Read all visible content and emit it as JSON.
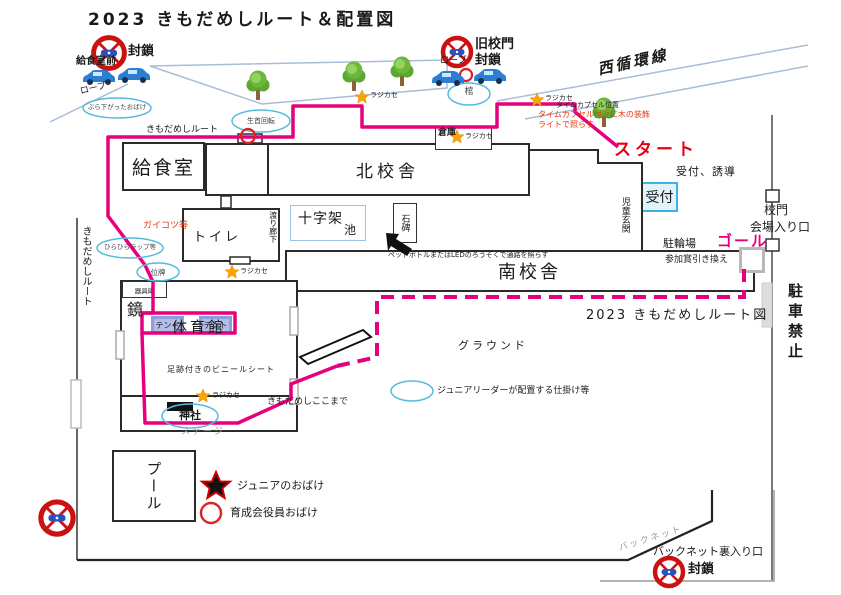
{
  "title": "2023 きもだめしルート＆配置図",
  "colors": {
    "route_pink": "#e6007d",
    "alert_red": "#cc1111",
    "note_red": "#e8380d",
    "star_orange": "#f7a600",
    "oval_blue": "#55bbdd",
    "reception_fill": "#e3f3fb"
  },
  "legend": {
    "junior_ghost": "ジュニアのおばけ",
    "staff_ghost": "育成会役員おばけ"
  },
  "labels": {
    "blockade_top_left": "封鎖",
    "kitchen_front": "給食室前",
    "rope_left": "ロープ",
    "hanging_ghost": "ぶら下がったおばけ",
    "rotating_head": "生首回転",
    "route_top": "きもだめしルート",
    "kitchen": "給食室",
    "north_building": "北校舎",
    "skeletons": "ガイコツ等",
    "flutter_wrap": "ひらひらラップ等",
    "memorial_tablet": "位牌",
    "toilet": "トイレ",
    "corridor": "渡り廊下",
    "cross": "十字架",
    "pond": "池",
    "stone_monument": "石碑",
    "bottle_note": "ペットボトルまたはLEDのろうそくで通路を照らす",
    "warehouse": "倉庫",
    "radio": "ラジカセ",
    "old_gate": "旧校門",
    "blockade_old_gate": "封鎖",
    "rope_right": "ロープ",
    "coffin": "棺",
    "west_loop_line": "西循環線",
    "time_capsule_pos": "タイムカプセル位置",
    "time_capsule_note1": "タイムカプセル付近に木の装飾",
    "time_capsule_note2": "ライトで照らす",
    "start": "スタート",
    "reception_guide": "受付、誘導",
    "reception": "受付",
    "children_entrance": "児童玄関",
    "school_gate": "校門",
    "venue_entrance": "会場入り口",
    "bicycle_parking": "駐輪場",
    "goal": "ゴール",
    "prize_exchange": "参加賞引き換え",
    "no_parking": "駐車禁止",
    "route_map_caption": "2023 きもだめしルート図",
    "south_building": "南校舎",
    "route_left": "きもだめしルート",
    "mirror": "鏡",
    "equipment_room": "器具庫",
    "tent": "テント",
    "gym": "体育館",
    "footprint_sheet": "足跡付きのビニールシート",
    "shrine": "神社",
    "stage": "ステージ",
    "route_end": "きもだめしここまで",
    "ground": "グラウンド",
    "junior_leader_trick": "ジュニアリーダーが配置する仕掛け等",
    "pool": "プール",
    "backnet": "バックネット",
    "backnet_entrance": "バックネット裏入り口",
    "blockade_backnet": "封鎖"
  }
}
